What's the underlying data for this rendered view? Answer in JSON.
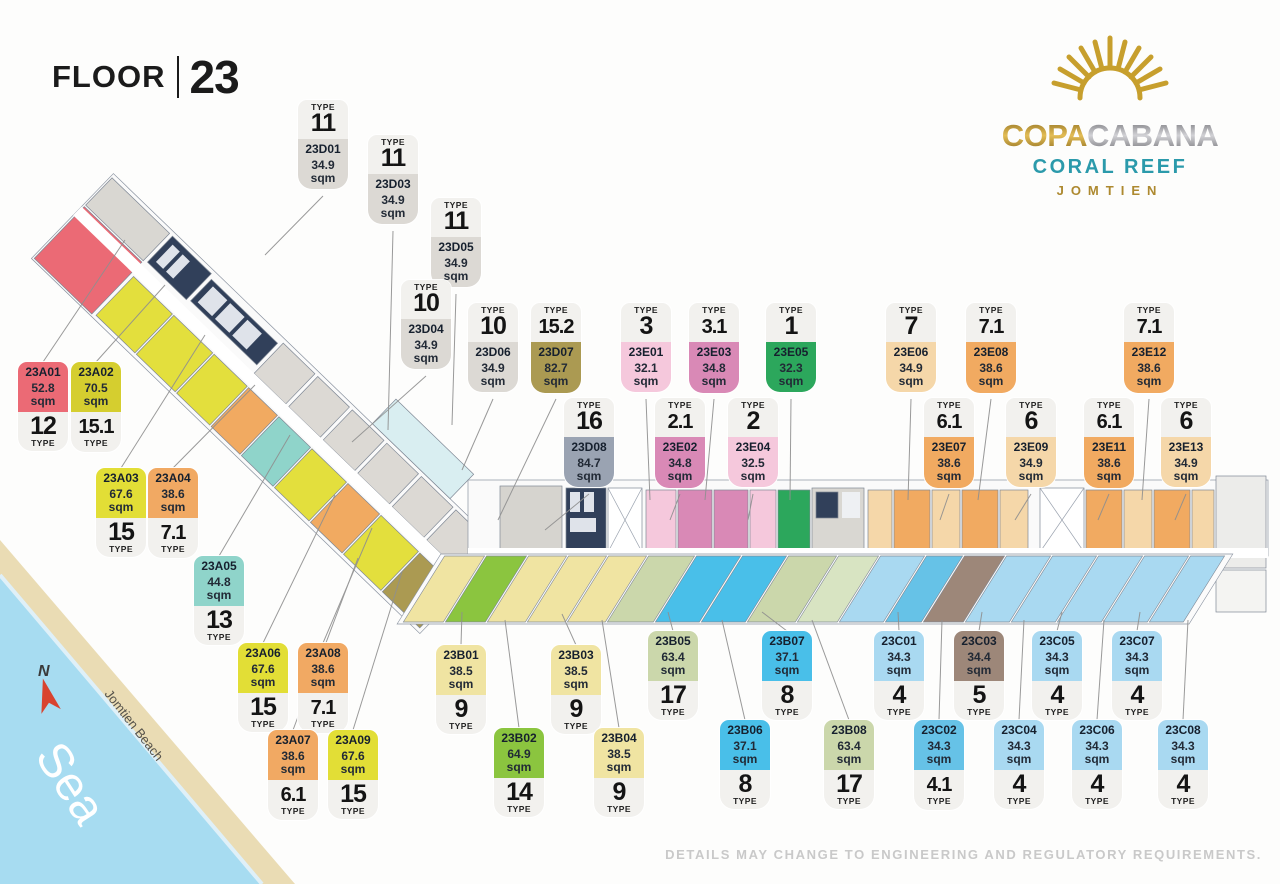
{
  "floor": {
    "label": "FLOOR",
    "number": "23"
  },
  "logo": {
    "brand_gold": "COPA",
    "brand_silver": "CABANA",
    "line2": "CORAL REEF",
    "line3": "JOMTIEN",
    "colors": {
      "gold": "#c79f2d",
      "silver": "#9a9a9e",
      "teal": "#2b9aab",
      "jomtien_gold": "#ad892f"
    }
  },
  "map": {
    "sea_label": "Sea",
    "beach_label": "Jomtien Beach",
    "compass": "N",
    "sea_color": "#a7dcf1",
    "sand_color": "#eadcb4"
  },
  "disclaimer": "DETAILS MAY CHANGE TO ENGINEERING AND REGULATORY REQUIREMENTS.",
  "tag_labels": {
    "type": "TYPE",
    "sqm": "sqm"
  },
  "units": [
    {
      "code": "23D01",
      "area": "34.9",
      "type": "11",
      "style": "type-top",
      "color": "#dcd9d4",
      "x": 298,
      "y": 100,
      "leader": [
        265,
        255
      ]
    },
    {
      "code": "23D03",
      "area": "34.9",
      "type": "11",
      "style": "type-top",
      "color": "#dcd9d4",
      "x": 368,
      "y": 135,
      "leader": [
        388,
        430
      ]
    },
    {
      "code": "23D05",
      "area": "34.9",
      "type": "11",
      "style": "type-top",
      "color": "#dcd9d4",
      "x": 431,
      "y": 198,
      "leader": [
        452,
        425
      ]
    },
    {
      "code": "23D04",
      "area": "34.9",
      "type": "10",
      "style": "type-top",
      "color": "#dcd9d4",
      "x": 401,
      "y": 280,
      "leader": [
        352,
        442
      ]
    },
    {
      "code": "23D06",
      "area": "34.9",
      "type": "10",
      "style": "type-top",
      "color": "#dcd9d4",
      "x": 468,
      "y": 303,
      "leader": [
        462,
        470
      ]
    },
    {
      "code": "23D07",
      "area": "82.7",
      "type": "15.2",
      "style": "type-top",
      "color": "#ab9a52",
      "x": 531,
      "y": 303,
      "leader": [
        498,
        520
      ]
    },
    {
      "code": "23D08",
      "area": "84.7",
      "type": "16",
      "style": "type-top",
      "color": "#9aa3b2",
      "x": 564,
      "y": 398,
      "leader": [
        545,
        530
      ]
    },
    {
      "code": "23E01",
      "area": "32.1",
      "type": "3",
      "style": "type-top",
      "color": "#f5c8dc",
      "x": 621,
      "y": 303,
      "leader": [
        650,
        500
      ]
    },
    {
      "code": "23E03",
      "area": "34.8",
      "type": "3.1",
      "style": "type-top",
      "color": "#d989b6",
      "x": 689,
      "y": 303,
      "leader": [
        705,
        500
      ]
    },
    {
      "code": "23E05",
      "area": "32.3",
      "type": "1",
      "style": "type-top",
      "color": "#2ca75c",
      "x": 766,
      "y": 303,
      "leader": [
        790,
        500
      ]
    },
    {
      "code": "23E02",
      "area": "34.8",
      "type": "2.1",
      "style": "type-top",
      "color": "#d989b6",
      "x": 655,
      "y": 398,
      "leader": [
        670,
        520
      ]
    },
    {
      "code": "23E04",
      "area": "32.5",
      "type": "2",
      "style": "type-top",
      "color": "#f5c8dc",
      "x": 728,
      "y": 398,
      "leader": [
        748,
        520
      ]
    },
    {
      "code": "23E06",
      "area": "34.9",
      "type": "7",
      "style": "type-top",
      "color": "#f5d7a9",
      "x": 886,
      "y": 303,
      "leader": [
        908,
        500
      ]
    },
    {
      "code": "23E08",
      "area": "38.6",
      "type": "7.1",
      "style": "type-top",
      "color": "#f1aa61",
      "x": 966,
      "y": 303,
      "leader": [
        978,
        500
      ]
    },
    {
      "code": "23E12",
      "area": "38.6",
      "type": "7.1",
      "style": "type-top",
      "color": "#f1aa61",
      "x": 1124,
      "y": 303,
      "leader": [
        1142,
        500
      ]
    },
    {
      "code": "23E07",
      "area": "38.6",
      "type": "6.1",
      "style": "type-top",
      "color": "#f1aa61",
      "x": 924,
      "y": 398,
      "leader": [
        940,
        520
      ]
    },
    {
      "code": "23E09",
      "area": "34.9",
      "type": "6",
      "style": "type-top",
      "color": "#f5d7a9",
      "x": 1006,
      "y": 398,
      "leader": [
        1015,
        520
      ]
    },
    {
      "code": "23E11",
      "area": "38.6",
      "type": "6.1",
      "style": "type-top",
      "color": "#f1aa61",
      "x": 1084,
      "y": 398,
      "leader": [
        1098,
        520
      ]
    },
    {
      "code": "23E13",
      "area": "34.9",
      "type": "6",
      "style": "type-top",
      "color": "#f5d7a9",
      "x": 1161,
      "y": 398,
      "leader": [
        1175,
        520
      ]
    },
    {
      "code": "23A01",
      "area": "52.8",
      "type": "12",
      "style": "type-bottom",
      "color": "#eb6a75",
      "x": 18,
      "y": 362,
      "leader": [
        125,
        240
      ]
    },
    {
      "code": "23A02",
      "area": "70.5",
      "type": "15.1",
      "style": "type-bottom",
      "color": "#d5ce2f",
      "x": 71,
      "y": 362,
      "leader": [
        165,
        285
      ]
    },
    {
      "code": "23A03",
      "area": "67.6",
      "type": "15",
      "style": "type-bottom",
      "color": "#e2de36",
      "x": 96,
      "y": 468,
      "leader": [
        205,
        335
      ]
    },
    {
      "code": "23A04",
      "area": "38.6",
      "type": "7.1",
      "style": "type-bottom",
      "color": "#f1a963",
      "x": 148,
      "y": 468,
      "leader": [
        255,
        385
      ]
    },
    {
      "code": "23A05",
      "area": "44.8",
      "type": "13",
      "style": "type-bottom",
      "color": "#8fd4ca",
      "x": 194,
      "y": 556,
      "leader": [
        290,
        435
      ]
    },
    {
      "code": "23A06",
      "area": "67.6",
      "type": "15",
      "style": "type-bottom",
      "color": "#e2de36",
      "x": 238,
      "y": 643,
      "leader": [
        335,
        495
      ]
    },
    {
      "code": "23A08",
      "area": "38.6",
      "type": "7.1",
      "style": "type-bottom",
      "color": "#f1a963",
      "x": 298,
      "y": 643,
      "leader": [
        372,
        528
      ]
    },
    {
      "code": "23A07",
      "area": "38.6",
      "type": "6.1",
      "style": "type-bottom",
      "color": "#f1a963",
      "x": 268,
      "y": 730,
      "leader": [
        358,
        558
      ]
    },
    {
      "code": "23A09",
      "area": "67.6",
      "type": "15",
      "style": "type-bottom",
      "color": "#e2de36",
      "x": 328,
      "y": 730,
      "leader": [
        402,
        572
      ]
    },
    {
      "code": "23B01",
      "area": "38.5",
      "type": "9",
      "style": "type-bottom",
      "color": "#f0e4a2",
      "x": 436,
      "y": 645,
      "leader": [
        462,
        612
      ]
    },
    {
      "code": "23B03",
      "area": "38.5",
      "type": "9",
      "style": "type-bottom",
      "color": "#f0e4a2",
      "x": 551,
      "y": 645,
      "leader": [
        562,
        614
      ]
    },
    {
      "code": "23B02",
      "area": "64.9",
      "type": "14",
      "style": "type-bottom",
      "color": "#8bc53f",
      "x": 494,
      "y": 728,
      "leader": [
        505,
        620
      ]
    },
    {
      "code": "23B04",
      "area": "38.5",
      "type": "9",
      "style": "type-bottom",
      "color": "#f0e4a2",
      "x": 594,
      "y": 728,
      "leader": [
        602,
        620
      ]
    },
    {
      "code": "23B05",
      "area": "63.4",
      "type": "17",
      "style": "type-bottom",
      "color": "#cbd7ab",
      "x": 648,
      "y": 631,
      "leader": [
        668,
        612
      ]
    },
    {
      "code": "23B07",
      "area": "37.1",
      "type": "8",
      "style": "type-bottom",
      "color": "#49bfe9",
      "x": 762,
      "y": 631,
      "leader": [
        762,
        612
      ]
    },
    {
      "code": "23B06",
      "area": "37.1",
      "type": "8",
      "style": "type-bottom",
      "color": "#49bfe9",
      "x": 720,
      "y": 720,
      "leader": [
        722,
        620
      ]
    },
    {
      "code": "23B08",
      "area": "63.4",
      "type": "17",
      "style": "type-bottom",
      "color": "#cbd7ab",
      "x": 824,
      "y": 720,
      "leader": [
        812,
        620
      ]
    },
    {
      "code": "23C01",
      "area": "34.3",
      "type": "4",
      "style": "type-bottom",
      "color": "#a9d9f1",
      "x": 874,
      "y": 631,
      "leader": [
        898,
        612
      ]
    },
    {
      "code": "23C03",
      "area": "34.4",
      "type": "5",
      "style": "type-bottom",
      "color": "#9d8779",
      "x": 954,
      "y": 631,
      "leader": [
        982,
        612
      ]
    },
    {
      "code": "23C05",
      "area": "34.3",
      "type": "4",
      "style": "type-bottom",
      "color": "#a9d9f1",
      "x": 1032,
      "y": 631,
      "leader": [
        1062,
        612
      ]
    },
    {
      "code": "23C07",
      "area": "34.3",
      "type": "4",
      "style": "type-bottom",
      "color": "#a9d9f1",
      "x": 1112,
      "y": 631,
      "leader": [
        1140,
        612
      ]
    },
    {
      "code": "23C02",
      "area": "34.3",
      "type": "4.1",
      "style": "type-bottom",
      "color": "#66c2e7",
      "x": 914,
      "y": 720,
      "leader": [
        942,
        620
      ]
    },
    {
      "code": "23C04",
      "area": "34.3",
      "type": "4",
      "style": "type-bottom",
      "color": "#a9d9f1",
      "x": 994,
      "y": 720,
      "leader": [
        1024,
        620
      ]
    },
    {
      "code": "23C06",
      "area": "34.3",
      "type": "4",
      "style": "type-bottom",
      "color": "#a9d9f1",
      "x": 1072,
      "y": 720,
      "leader": [
        1104,
        620
      ]
    },
    {
      "code": "23C08",
      "area": "34.3",
      "type": "4",
      "style": "type-bottom",
      "color": "#a9d9f1",
      "x": 1158,
      "y": 720,
      "leader": [
        1188,
        620
      ]
    }
  ]
}
